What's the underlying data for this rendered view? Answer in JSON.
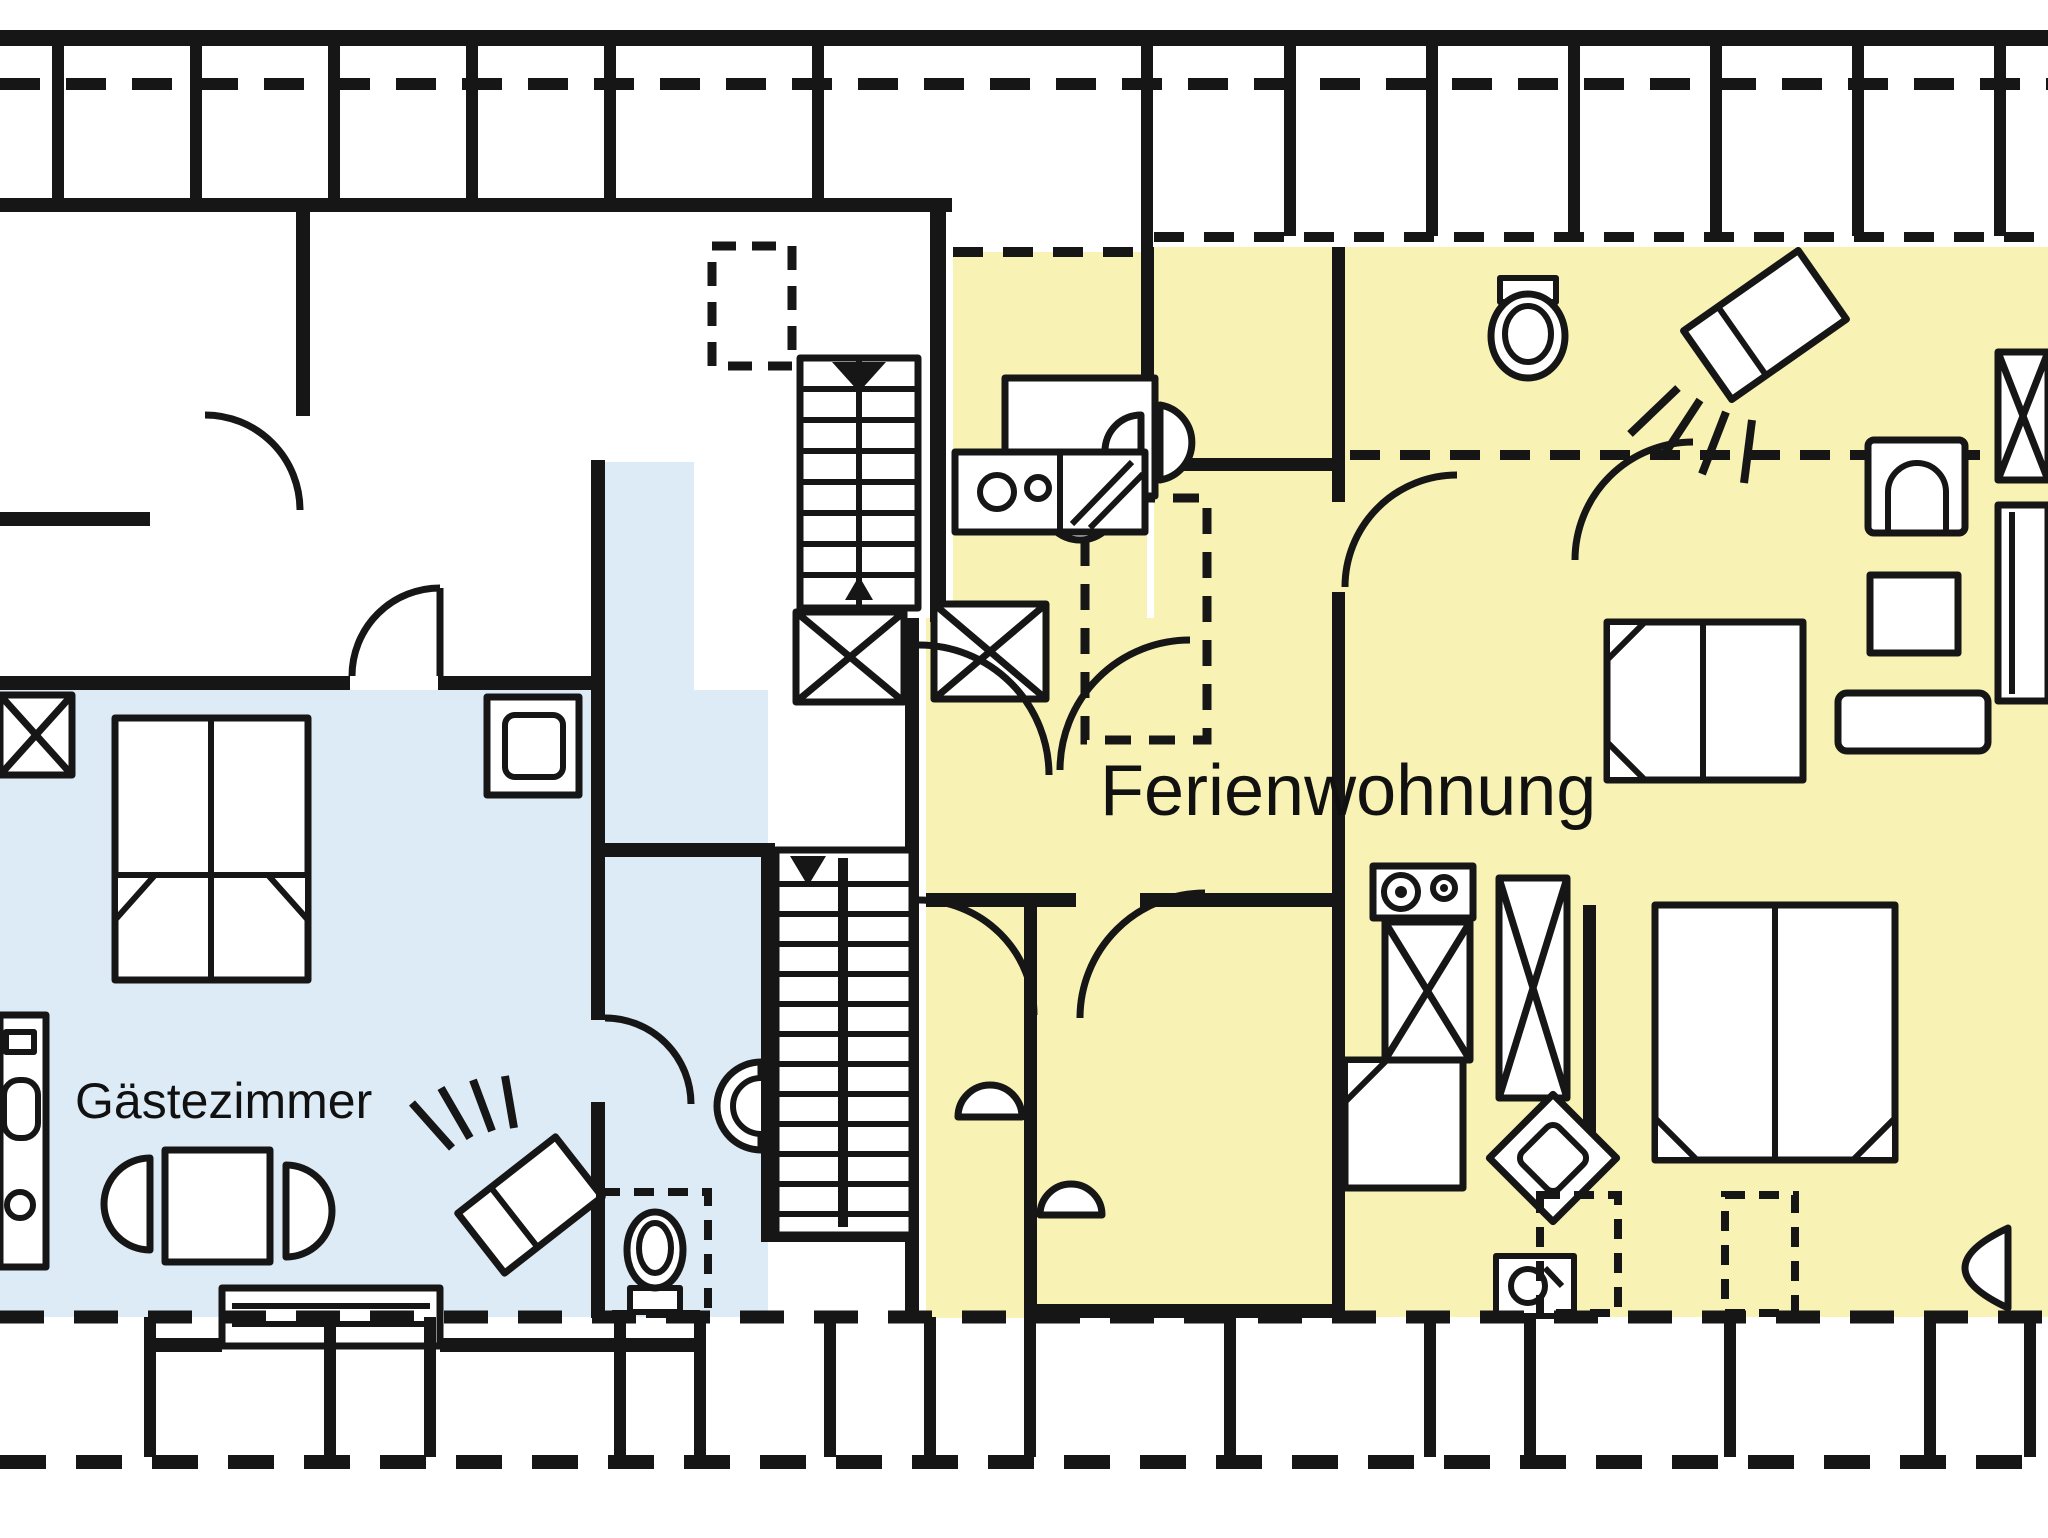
{
  "title": "Attic floor plan with holiday apartment and guest room",
  "colors": {
    "wall": "#161616",
    "background": "#ffffff",
    "ferienwohnung_fill": "#f8f3b4",
    "gaestezimmer_fill": "#dcebf6"
  },
  "rooms": {
    "ferienwohnung": {
      "label": "Ferienwohnung"
    },
    "gaestezimmer": {
      "label": "Gästezimmer"
    }
  },
  "elements": {
    "roof_lines": [
      "top-knee-wall-dashed-line",
      "bottom-knee-wall-dashed-line",
      "attic-storage-bays"
    ],
    "circulation": [
      "upper-staircase-with-down-arrow",
      "lower-staircase-two-flights",
      "shaft-x-boxes",
      "door-swing-arcs"
    ],
    "gaestezimmer_fixtures": [
      "double-bed",
      "table-with-two-chairs",
      "wash-cabinet",
      "shower-head-symbol",
      "shower-tray",
      "wc-toilet-in-dashed-niche",
      "washbasin-on-stair-wall",
      "dormer-window"
    ],
    "ferienwohnung_fixtures": [
      "dining-table-with-chairs",
      "kitchenette-counter-with-burners",
      "toilet",
      "washbasin",
      "shower-head-symbol",
      "double-bed-top-right",
      "double-bed-bottom-right",
      "armchair",
      "side-table",
      "wardrobe-x-box",
      "couch",
      "bench",
      "stove-with-burners",
      "tall-cupboards",
      "fridge-counter",
      "shower-tray-diamond",
      "washbasin-square",
      "dashed-bedside-tables",
      "half-round-chairs"
    ]
  }
}
